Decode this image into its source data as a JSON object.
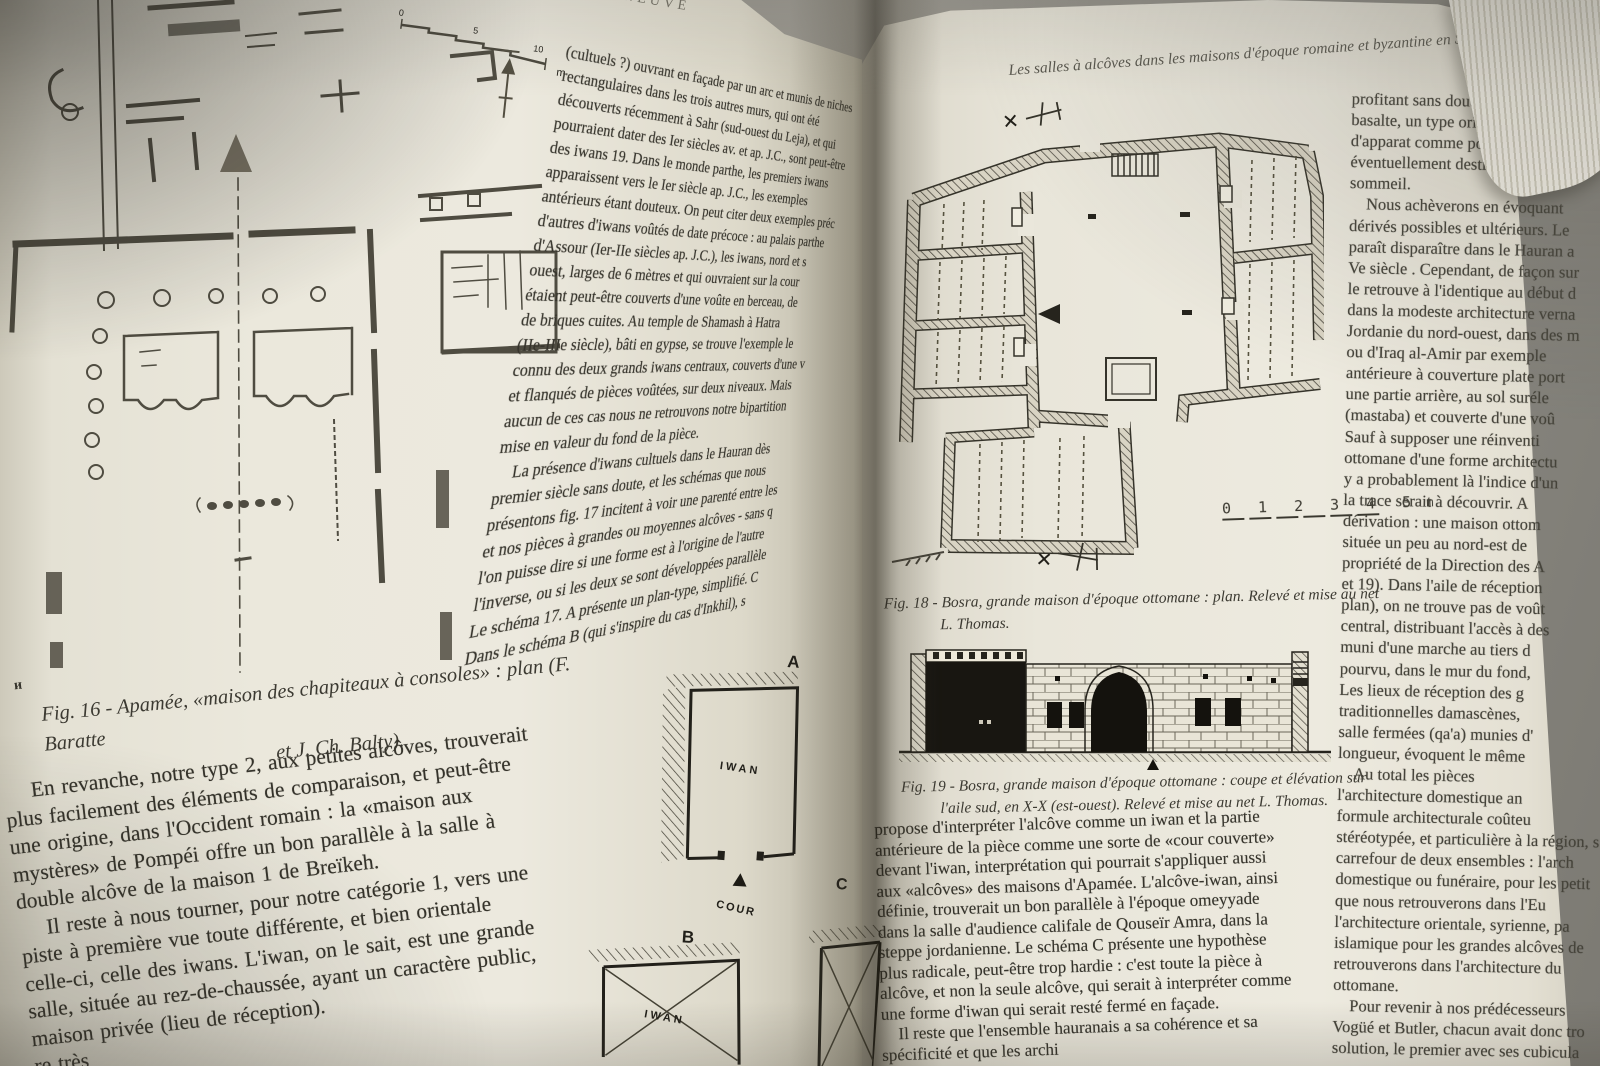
{
  "photo": {
    "background_color": "#8f8d86",
    "page_color": "#ebe8dc",
    "ink_color": "#35332b"
  },
  "left_page": {
    "running_head": "LENEUVE",
    "scale_bar": {
      "tick0": "0",
      "tick1": "5",
      "tick2": "10",
      "unit": "m"
    },
    "figure16": {
      "caption_line1": "Fig. 16 - Apamée, «maison des chapiteaux à consoles» : plan (F. Baratte",
      "caption_line2": "et J. Ch. Balty).",
      "stray_mark": "ᴎ"
    },
    "mid_column_lines": [
      "(cultuels ?) ouvrant en façade par un arc et munis de niches",
      "rectangulaires dans les trois autres murs, qui ont été",
      "découverts récemment à Sahr (sud-ouest du Leja), et qui",
      "pourraient dater des Ier siècles av. et ap. J.C., sont peut-être",
      "des iwans 19. Dans le monde parthe, les premiers iwans",
      "apparaissent vers le Ier siècle ap. J.C., les exemples",
      "antérieurs étant douteux. On peut citer deux exemples préc",
      "d'autres d'iwans voûtés de date précoce : au palais parthe",
      "d'Assour (Ier-IIe siècles ap. J.C.), les iwans, nord et s",
      "ouest, larges de 6 mètres et qui ouvraient sur la cour",
      "étaient peut-être couverts d'une voûte en berceau, de",
      "de briques cuites. Au temple de Shamash à Hatra",
      "(IIe-IIIe siècle), bâti en gypse, se trouve l'exemple le",
      "connu des deux grands iwans centraux, couverts d'une v",
      "et flanqués de pièces voûtées, sur deux niveaux. Mais",
      "aucun de ces cas nous ne retrouvons notre bipartition",
      "mise en valeur du fond de la pièce.",
      "    La présence d'iwans cultuels dans le Hauran dès",
      "premier siècle sans doute, et les schémas que nous",
      "présentons fig. 17 incitent à voir une parenté entre les",
      "et nos pièces à grandes ou moyennes alcôves - sans q",
      "l'on puisse dire si une forme est à l'origine de l'autre",
      "l'inverse, ou si les deux se sont développées parallèle",
      "Le schéma 17. A présente un plan-type, simplifié. C",
      "Dans le schéma B (qui s'inspire du cas d'Inkhil), s"
    ],
    "bottom_lines": [
      "    En revanche, notre type 2, aux petites alcôves, trouverait",
      "plus facilement des éléments de comparaison, et peut-être",
      "une origine, dans l'Occident romain : la «maison aux",
      "mystères» de Pompéi offre un bon parallèle à la salle à",
      "double alcôve de la maison 1 de Breïkeh.",
      "    Il reste à nous tourner, pour notre catégorie 1, vers une",
      "piste à première vue toute différente, et bien orientale",
      "celle-ci, celle des iwans. L'iwan, on le sait, est une grande",
      "salle, située au rez-de-chaussée, ayant un caractère public,",
      "maison privée (lieu de réception).",
      "re très"
    ],
    "figure17": {
      "label_a": "A",
      "label_b": "B",
      "label_c": "C",
      "room_label": "IWAN",
      "court_label": "COUR"
    }
  },
  "right_page": {
    "running_head": "Les salles à alcôves dans les maisons d'époque romaine et byzantine en Syrie.",
    "figure18": {
      "caption_line1": "Fig. 18 - Bosra, grande maison d'époque ottomane : plan. Relevé et mise au net",
      "caption_line2": "L. Thomas.",
      "section_marker": "✕",
      "scale_numbers": "0 1 2 3 4 5",
      "scale_unit": "m"
    },
    "figure19": {
      "caption_line1": "Fig. 19 - Bosra, grande maison d'époque ottomane : coupe et élévation sur",
      "caption_line2": "l'aile sud, en X-X (est-ouest). Relevé et mise au net L. Thomas."
    },
    "mid_column_lines": [
      "propose d'interpréter l'alcôve comme un iwan et la partie",
      "antérieure de la pièce comme une sorte de «cour couverte»",
      "devant l'iwan, interprétation qui pourrait s'appliquer aussi",
      "aux «alcôves» des maisons d'Apamée. L'alcôve-iwan, ainsi",
      "définie, trouverait un bon parallèle à l'époque omeyyade",
      "dans la salle d'audience califale de Qouseïr Amra, dans la",
      "steppe jordanienne. Le schéma C présente une hypothèse",
      "plus radicale, peut-être trop hardie : c'est toute la pièce à",
      "alcôve, et non la seule alcôve, qui serait à interpréter comme",
      "une forme d'iwan qui serait resté fermé en façade.",
      "    Il reste que l'ensemble hauranais a sa cohérence et sa",
      "spécificité et que les archi",
      "pour"
    ],
    "right_column_lines": [
      "profitant sans doute des facilités off",
      "basalte, un type original, pour les gra",
      "d'apparat comme pour leurs annexe",
      "éventuellement destinées aussi,",
      "sommeil.",
      "    Nous achèverons en évoquant",
      "dérivés possibles et ultérieurs. Le",
      "paraît disparaître dans le Hauran a",
      "Ve siècle . Cependant, de façon sur",
      "le retrouve à l'identique au début d",
      "dans la modeste architecture verna",
      "Jordanie du nord-ouest, dans des m",
      "ou d'Iraq al-Amir par exemple",
      "antérieure à couverture plate port",
      "une partie arrière, au sol suréle",
      "(mastaba) et couverte d'une voû",
      "Sauf à supposer une réinventi",
      "ottomane d'une forme architectu",
      "y a probablement là l'indice d'un",
      "la trace serait à découvrir. A",
      "dérivation : une maison ottom",
      "située un peu au nord-est de",
      "propriété de la Direction des A",
      "et 19). Dans l'aile de réception",
      "plan), on ne trouve pas de voût",
      "central, distribuant l'accès à des",
      "muni d'une marche au tiers d",
      "pourvu, dans le mur du fond,",
      "Les lieux de réception des g",
      "traditionnelles damascènes,",
      "salle fermées (qa'a) munies d'",
      "longueur, évoquent le même",
      "    Au total les pièces",
      "l'architecture domestique an",
      "formule architecturale coûteu",
      "stéréotypée, et particulière à la région, s",
      "carrefour de deux ensembles : l'arch",
      "domestique ou funéraire, pour les petit",
      "que nous retrouverons dans l'Eu",
      "l'architecture orientale, syrienne, pa",
      "islamique pour les grandes alcôves de",
      "retrouverons dans l'architecture du",
      "ottomane.",
      "    Pour revenir à nos prédécesseurs",
      "Vogüé et Butler, chacun avait donc tro",
      "solution, le premier avec ses cubicula"
    ]
  }
}
